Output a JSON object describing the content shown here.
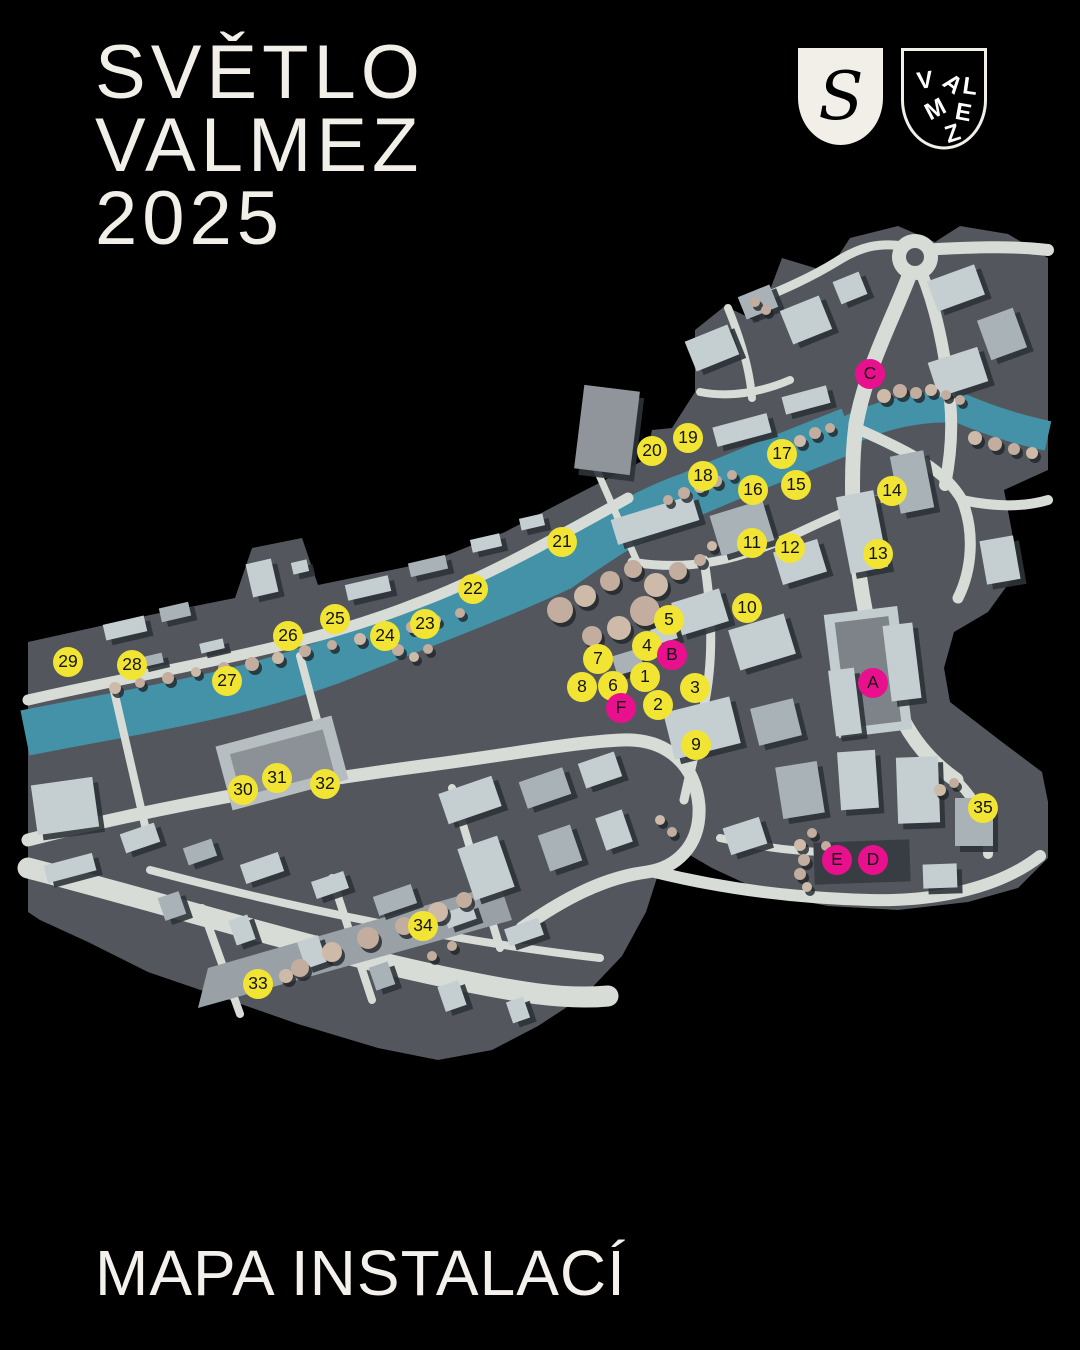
{
  "title": {
    "line1": "SVĚTLO",
    "line2": "VALMEZ",
    "line3": "2025"
  },
  "footer": {
    "caption": "MAPA INSTALACÍ"
  },
  "logos": {
    "s_monogram": "S",
    "valmez_letters": [
      "V",
      "A",
      "L",
      "M",
      "E",
      "Z"
    ]
  },
  "colors": {
    "background": "#000000",
    "marker_yellow": "#f1e433",
    "marker_pink": "#e9108e",
    "marker_text": "#141414",
    "river": "#4492a8",
    "land": "#53575d",
    "road": "#d7dcd6",
    "building_light": "#c5cfd2",
    "building_mid": "#a9b3b7",
    "tree": "#c2ad9e",
    "title_text": "#f2efe9"
  },
  "map": {
    "markers": [
      {
        "label": "5",
        "type": "number",
        "x": 669,
        "y": 620
      },
      {
        "label": "4",
        "type": "number",
        "x": 647,
        "y": 646
      },
      {
        "label": "B",
        "type": "letter",
        "x": 672,
        "y": 655
      },
      {
        "label": "7",
        "type": "number",
        "x": 598,
        "y": 659
      },
      {
        "label": "1",
        "type": "number",
        "x": 645,
        "y": 677
      },
      {
        "label": "8",
        "type": "number",
        "x": 582,
        "y": 687
      },
      {
        "label": "6",
        "type": "number",
        "x": 613,
        "y": 686
      },
      {
        "label": "F",
        "type": "letter",
        "x": 621,
        "y": 708
      },
      {
        "label": "2",
        "type": "number",
        "x": 658,
        "y": 705
      },
      {
        "label": "3",
        "type": "number",
        "x": 695,
        "y": 688
      },
      {
        "label": "9",
        "type": "number",
        "x": 696,
        "y": 745
      },
      {
        "label": "10",
        "type": "number",
        "x": 747,
        "y": 608
      },
      {
        "label": "11",
        "type": "number",
        "x": 752,
        "y": 543
      },
      {
        "label": "12",
        "type": "number",
        "x": 790,
        "y": 548
      },
      {
        "label": "13",
        "type": "number",
        "x": 878,
        "y": 554
      },
      {
        "label": "14",
        "type": "number",
        "x": 892,
        "y": 491
      },
      {
        "label": "15",
        "type": "number",
        "x": 796,
        "y": 485
      },
      {
        "label": "16",
        "type": "number",
        "x": 753,
        "y": 490
      },
      {
        "label": "17",
        "type": "number",
        "x": 782,
        "y": 454
      },
      {
        "label": "18",
        "type": "number",
        "x": 703,
        "y": 476
      },
      {
        "label": "19",
        "type": "number",
        "x": 688,
        "y": 438
      },
      {
        "label": "20",
        "type": "number",
        "x": 652,
        "y": 451
      },
      {
        "label": "21",
        "type": "number",
        "x": 562,
        "y": 542
      },
      {
        "label": "22",
        "type": "number",
        "x": 473,
        "y": 589
      },
      {
        "label": "23",
        "type": "number",
        "x": 425,
        "y": 624
      },
      {
        "label": "24",
        "type": "number",
        "x": 385,
        "y": 636
      },
      {
        "label": "25",
        "type": "number",
        "x": 335,
        "y": 619
      },
      {
        "label": "26",
        "type": "number",
        "x": 288,
        "y": 636
      },
      {
        "label": "27",
        "type": "number",
        "x": 227,
        "y": 681
      },
      {
        "label": "28",
        "type": "number",
        "x": 132,
        "y": 665
      },
      {
        "label": "29",
        "type": "number",
        "x": 68,
        "y": 662
      },
      {
        "label": "30",
        "type": "number",
        "x": 243,
        "y": 790
      },
      {
        "label": "31",
        "type": "number",
        "x": 277,
        "y": 778
      },
      {
        "label": "32",
        "type": "number",
        "x": 325,
        "y": 784
      },
      {
        "label": "33",
        "type": "number",
        "x": 258,
        "y": 984
      },
      {
        "label": "34",
        "type": "number",
        "x": 423,
        "y": 926
      },
      {
        "label": "35",
        "type": "number",
        "x": 983,
        "y": 808
      },
      {
        "label": "A",
        "type": "letter",
        "x": 873,
        "y": 683
      },
      {
        "label": "C",
        "type": "letter",
        "x": 870,
        "y": 374
      },
      {
        "label": "D",
        "type": "letter",
        "x": 873,
        "y": 860
      },
      {
        "label": "E",
        "type": "letter",
        "x": 837,
        "y": 860
      }
    ]
  }
}
